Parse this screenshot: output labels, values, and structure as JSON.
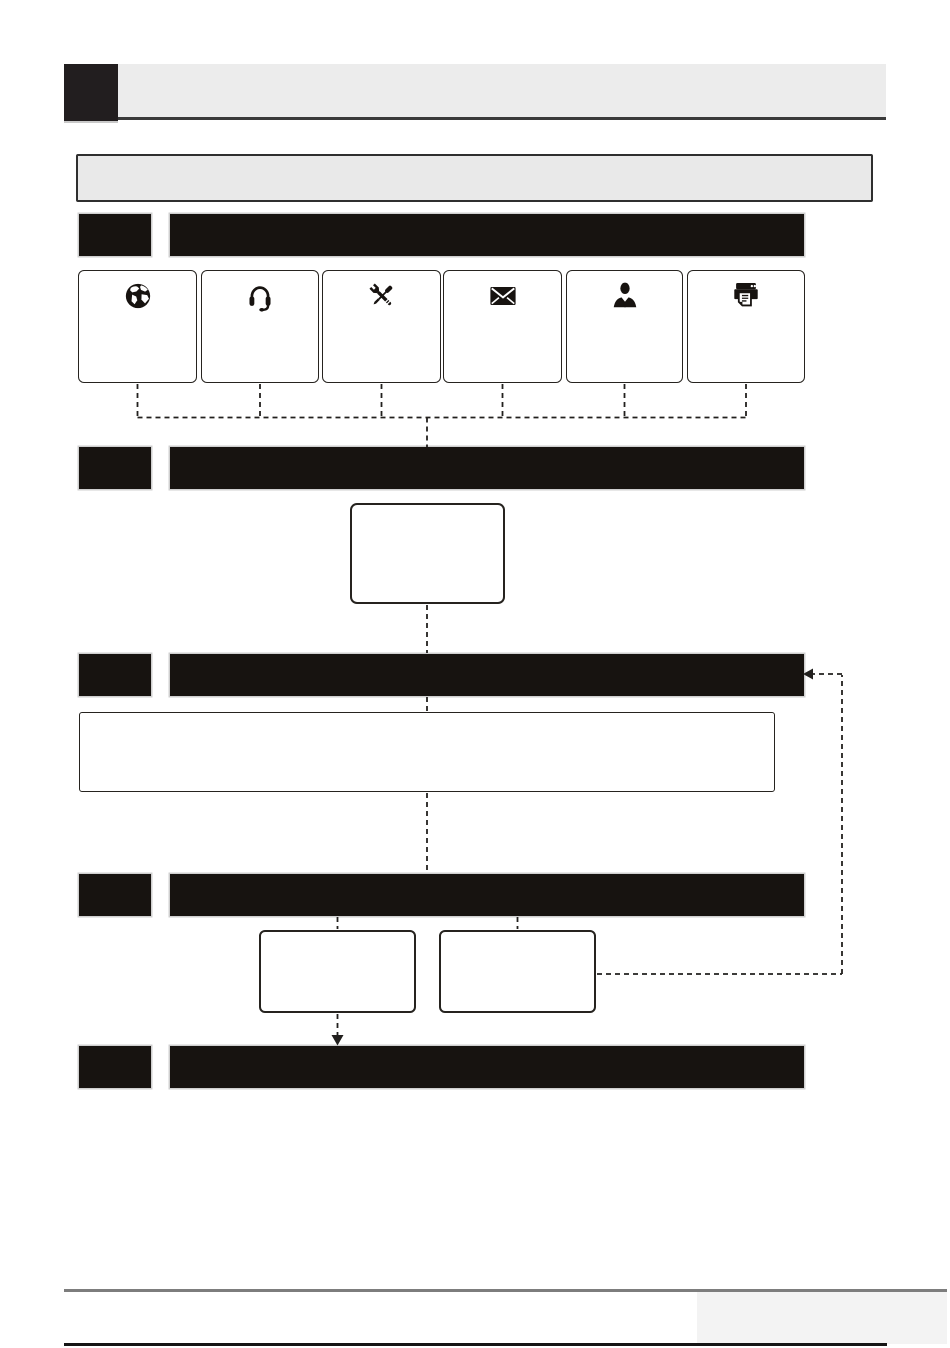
{
  "page": {
    "kind": "user-manual flowchart page",
    "width_px": 950,
    "height_px": 1348,
    "background": "#ffffff"
  },
  "header": {
    "chapter_square_text": "",
    "band_title_text": ""
  },
  "intro_box": {
    "text": ""
  },
  "contact_channels": {
    "icons": [
      "globe",
      "headset",
      "tools",
      "envelope",
      "businessman",
      "printer"
    ],
    "labels": [
      "",
      "",
      "",
      "",
      "",
      ""
    ]
  },
  "flow": {
    "sections": [
      {
        "number_text": "",
        "title_text": ""
      },
      {
        "number_text": "",
        "title_text": ""
      },
      {
        "number_text": "",
        "title_text": ""
      },
      {
        "number_text": "",
        "title_text": ""
      },
      {
        "number_text": "",
        "title_text": ""
      }
    ],
    "boxes": {
      "step_box_text": "",
      "wide_note_text": "",
      "result_left_text": "",
      "result_right_text": ""
    },
    "connector_style": "dashed",
    "arrows": [
      "down-arrow-into-section-5",
      "left-arrow-into-section-3-feedback-loop"
    ]
  },
  "footer": {
    "left_text": "",
    "right_box_text": ""
  },
  "colors": {
    "bar": "#171310",
    "header_square": "#221e1f",
    "header_band": "#ececec",
    "header_underline": "#3a3a3a",
    "intro_fill": "#e9e9e9",
    "intro_border": "#2f2f2f",
    "box_border": "#26231f",
    "connector": "#22201e",
    "footer_gray_line": "#7d7d7d",
    "footer_black_line": "#151515",
    "footer_gray_rect": "#f3f3f3"
  }
}
